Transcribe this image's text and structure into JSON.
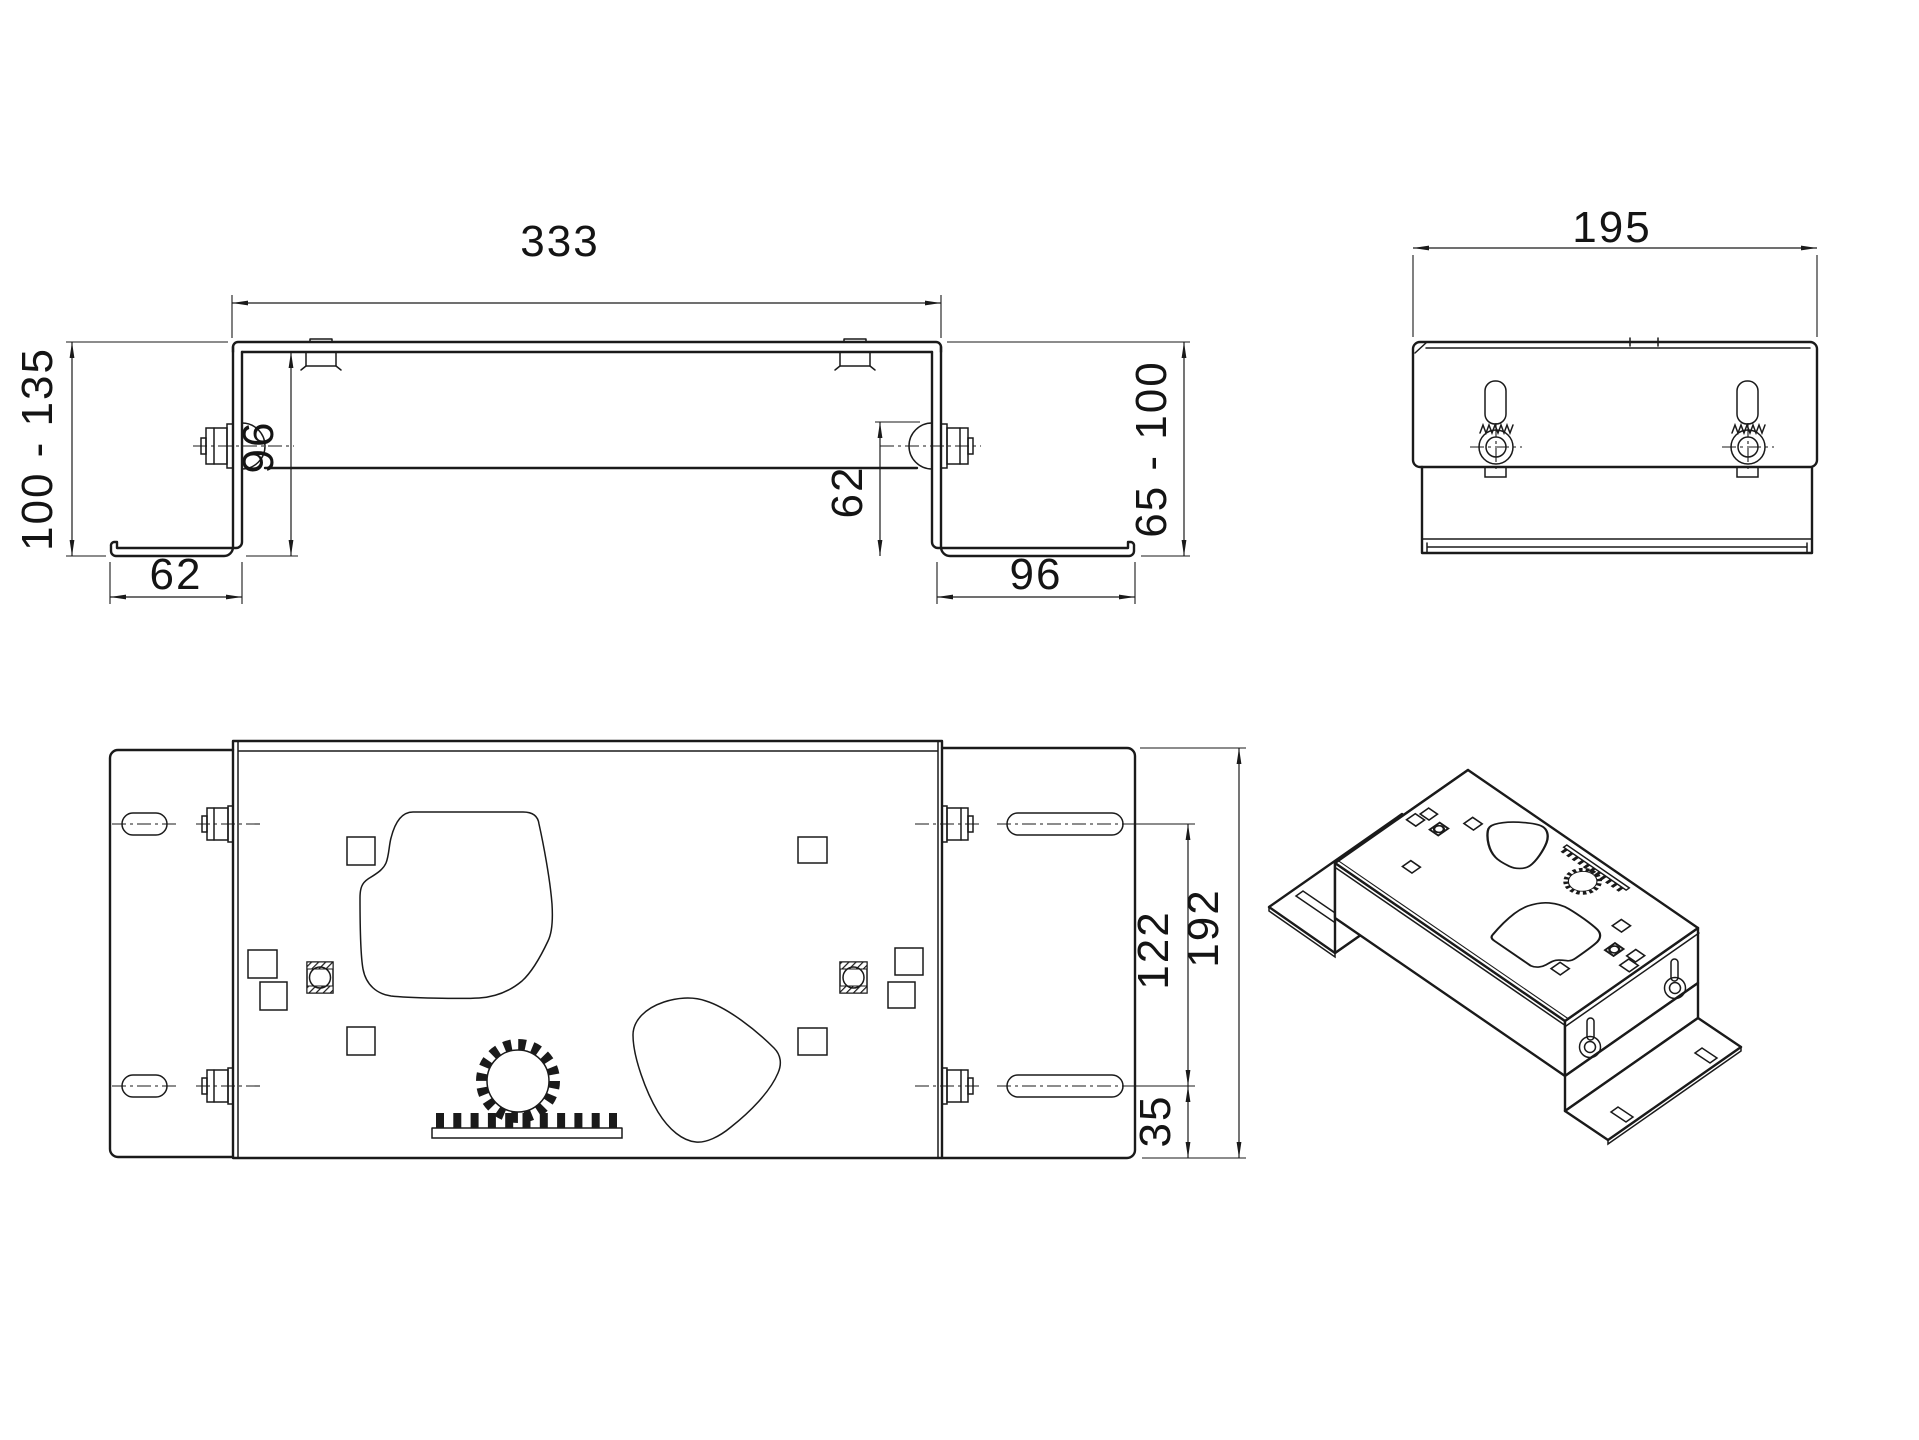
{
  "drawing": {
    "type": "multi-view technical drawing of adjustable mounting bracket",
    "colors": {
      "background": "#ffffff",
      "line": "#1a1a1a"
    },
    "views": {
      "front_view": {
        "dim_width": "333",
        "dim_height_left": "100 - 135",
        "dim_leg_left": "96",
        "dim_foot_left": "62",
        "dim_drop_right": "62",
        "dim_foot_right": "96",
        "dim_height_right": "65 - 100"
      },
      "side_view": {
        "dim_width": "195"
      },
      "top_view": {
        "dim_slot_spacing": "122",
        "dim_flange_offset": "35",
        "dim_depth": "192"
      },
      "isometric_view": {}
    }
  }
}
